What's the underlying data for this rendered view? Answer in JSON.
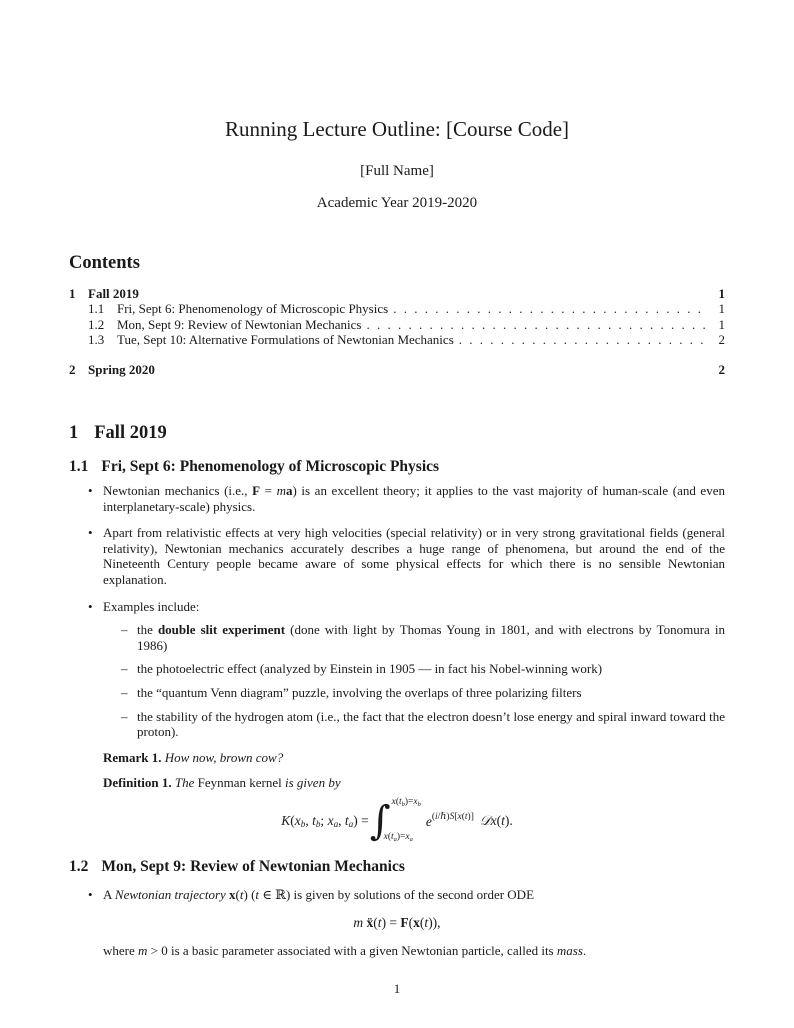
{
  "doc": {
    "title": "Running Lecture Outline: [Course Code]",
    "author": "[Full Name]",
    "date": "Academic Year 2019-2020",
    "page_number": "1"
  },
  "markers": {
    "bullet": "•",
    "dash": "–"
  },
  "toc": {
    "heading": "Contents",
    "entries": [
      {
        "num": "1",
        "label": "Fall 2019",
        "page": "1"
      },
      {
        "num": "1.1",
        "label": "Fri, Sept 6: Phenomenology of Microscopic Physics",
        "page": "1"
      },
      {
        "num": "1.2",
        "label": "Mon, Sept 9: Review of Newtonian Mechanics",
        "page": "1"
      },
      {
        "num": "1.3",
        "label": "Tue, Sept 10: Alternative Formulations of Newtonian Mechanics",
        "page": "2"
      },
      {
        "num": "2",
        "label": "Spring 2020",
        "page": "2"
      }
    ]
  },
  "sections": {
    "fall": {
      "num": "1",
      "title": "Fall 2019"
    },
    "s11": {
      "num": "1.1",
      "title": "Fri, Sept 6: Phenomenology of Microscopic Physics"
    },
    "s12": {
      "num": "1.2",
      "title": "Mon, Sept 9: Review of Newtonian Mechanics"
    }
  },
  "s11": {
    "b1": [
      {
        "t": "Newtonian mechanics (i.e., "
      },
      {
        "t": "F",
        "s": "b"
      },
      {
        "t": " = "
      },
      {
        "t": "m",
        "s": "i"
      },
      {
        "t": "a",
        "s": "b"
      },
      {
        "t": ") is an excellent theory; it applies to the vast majority of human-scale (and even interplanetary-scale) physics."
      }
    ],
    "b2": [
      {
        "t": "Apart from relativistic effects at very high velocities (special relativity) or in very strong gravitational fields (general relativity), Newtonian mechanics accurately describes a huge range of phenomena, but around the end of the Nineteenth Century people became aware of some physical effects for which there is no sensible Newtonian explanation."
      }
    ],
    "b3": [
      {
        "t": "Examples include:"
      }
    ],
    "d1": [
      {
        "t": "the "
      },
      {
        "t": "double slit experiment",
        "s": "b"
      },
      {
        "t": " (done with light by Thomas Young in 1801, and with electrons by Tonomura in 1986)"
      }
    ],
    "d2": [
      {
        "t": "the photoelectric effect (analyzed by Einstein in 1905 — in fact his Nobel-winning work)"
      }
    ],
    "d3": [
      {
        "t": "the “quantum Venn diagram” puzzle, involving the overlaps of three polarizing filters"
      }
    ],
    "d4": [
      {
        "t": "the stability of the hydrogen atom (i.e., the fact that the electron doesn’t lose energy and spiral inward toward the proton)."
      }
    ],
    "remark": [
      {
        "t": "Remark 1.",
        "s": "b"
      },
      {
        "t": " How now, brown cow?",
        "s": "i"
      }
    ],
    "definition": [
      {
        "t": "Definition 1.",
        "s": "b"
      },
      {
        "t": " The ",
        "s": "i"
      },
      {
        "t": "Feynman kernel"
      },
      {
        "t": " is given by",
        "s": "i"
      }
    ],
    "formula": {
      "int_sign": "∫",
      "lhs": [
        {
          "t": "K",
          "s": "i"
        },
        {
          "t": "("
        },
        {
          "t": "x",
          "s": "i"
        },
        {
          "t": "b",
          "s": "sub"
        },
        {
          "t": ", "
        },
        {
          "t": "t",
          "s": "i"
        },
        {
          "t": "b",
          "s": "sub"
        },
        {
          "t": "; "
        },
        {
          "t": "x",
          "s": "i"
        },
        {
          "t": "a",
          "s": "sub"
        },
        {
          "t": ", "
        },
        {
          "t": "t",
          "s": "i"
        },
        {
          "t": "a",
          "s": "sub"
        },
        {
          "t": ") = "
        }
      ],
      "upper": [
        {
          "t": "x",
          "s": "i"
        },
        {
          "t": "("
        },
        {
          "t": "t",
          "s": "i"
        },
        {
          "t": "b",
          "s": "sub"
        },
        {
          "t": ")="
        },
        {
          "t": "x",
          "s": "i"
        },
        {
          "t": "b",
          "s": "sub"
        }
      ],
      "lower": [
        {
          "t": "x",
          "s": "i"
        },
        {
          "t": "("
        },
        {
          "t": "t",
          "s": "i"
        },
        {
          "t": "a",
          "s": "sub"
        },
        {
          "t": ")="
        },
        {
          "t": "x",
          "s": "i"
        },
        {
          "t": "a",
          "s": "sub"
        }
      ],
      "ebase": [
        {
          "t": "e",
          "s": "i"
        }
      ],
      "esup": [
        {
          "t": "("
        },
        {
          "t": "i",
          "s": "i"
        },
        {
          "t": "/ℏ)"
        },
        {
          "t": "S",
          "s": "i"
        },
        {
          "t": "["
        },
        {
          "t": "x",
          "s": "i"
        },
        {
          "t": "("
        },
        {
          "t": "t",
          "s": "i"
        },
        {
          "t": ")]"
        }
      ],
      "measure": [
        {
          "t": "𝒟",
          "s": "scr"
        },
        {
          "t": "x",
          "s": "i"
        },
        {
          "t": "("
        },
        {
          "t": "t",
          "s": "i"
        },
        {
          "t": ")."
        }
      ]
    }
  },
  "s12": {
    "b1": [
      {
        "t": "A "
      },
      {
        "t": "Newtonian trajectory",
        "s": "i"
      },
      {
        "t": " "
      },
      {
        "t": "x",
        "s": "b"
      },
      {
        "t": "("
      },
      {
        "t": "t",
        "s": "i"
      },
      {
        "t": ") ("
      },
      {
        "t": "t",
        "s": "i"
      },
      {
        "t": " ∈ ℝ) is given by solutions of the second order ODE"
      }
    ],
    "eq": [
      {
        "t": "m",
        "s": "i"
      },
      {
        "t": " "
      },
      {
        "t": "ẍ",
        "s": "b"
      },
      {
        "t": "("
      },
      {
        "t": "t",
        "s": "i"
      },
      {
        "t": ") = "
      },
      {
        "t": "F",
        "s": "b"
      },
      {
        "t": "("
      },
      {
        "t": "x",
        "s": "b"
      },
      {
        "t": "("
      },
      {
        "t": "t",
        "s": "i"
      },
      {
        "t": ")),"
      }
    ],
    "after": [
      {
        "t": "where "
      },
      {
        "t": "m",
        "s": "i"
      },
      {
        "t": " > 0 is a basic parameter associated with a given Newtonian particle, called its "
      },
      {
        "t": "mass",
        "s": "i"
      },
      {
        "t": "."
      }
    ]
  }
}
